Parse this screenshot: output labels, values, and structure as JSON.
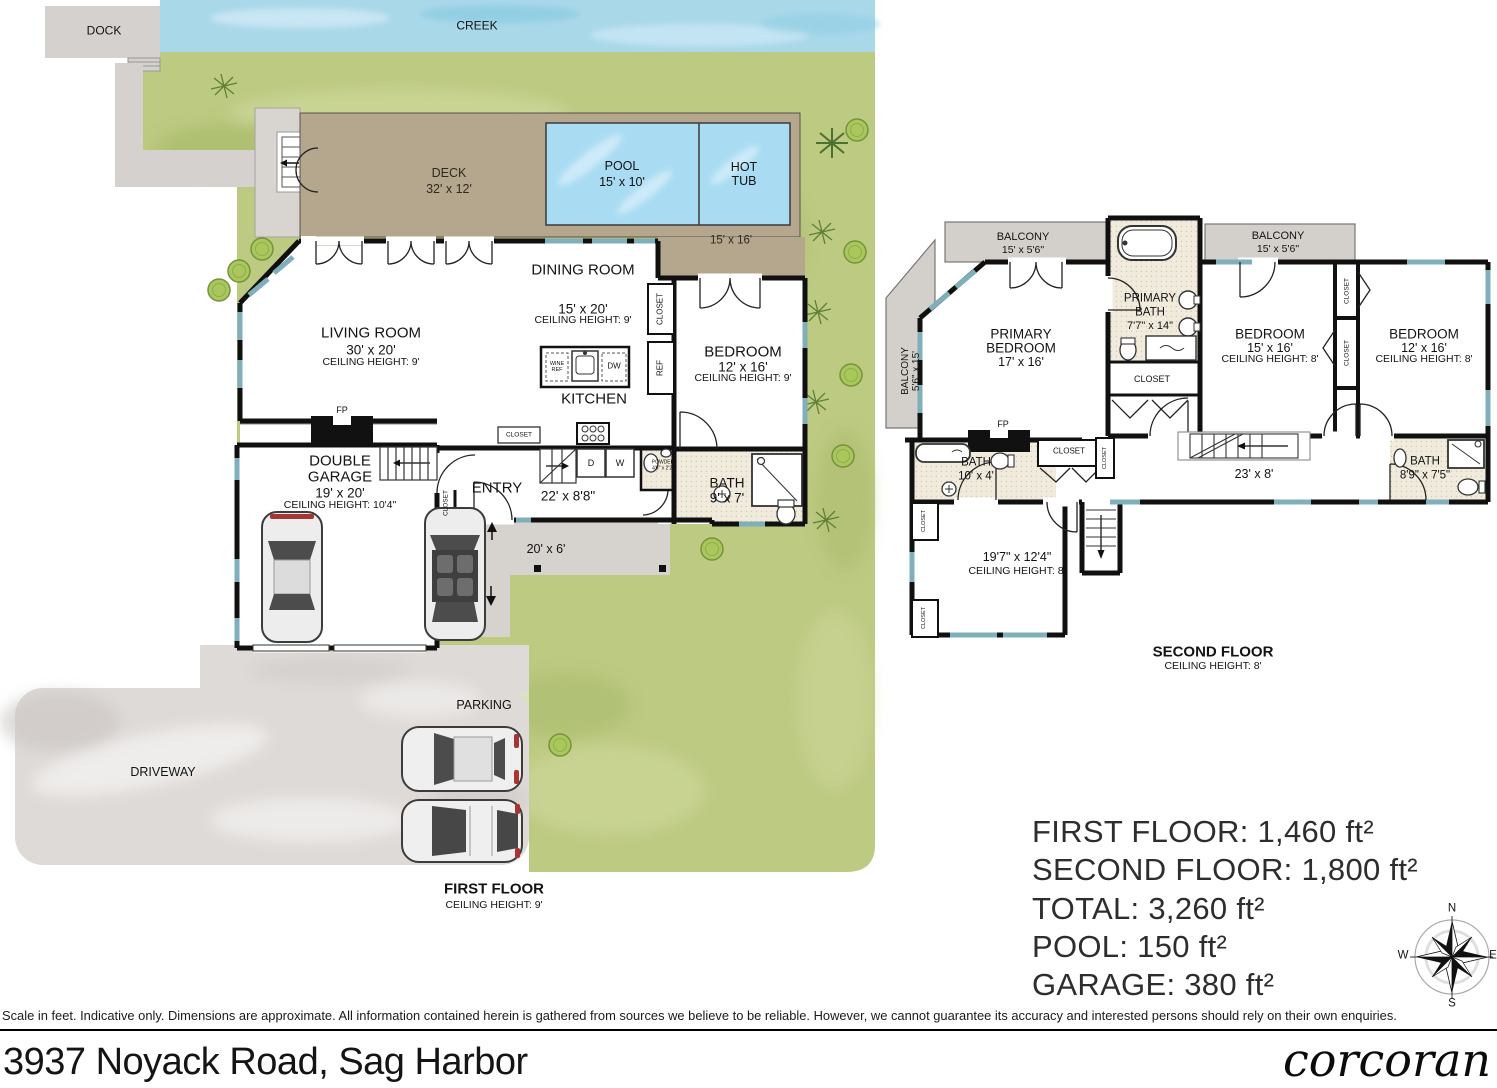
{
  "site": {
    "dock": "DOCK",
    "creek": "CREEK",
    "deck": {
      "name": "DECK",
      "dims": "32' x 12'"
    },
    "pool": {
      "name": "POOL",
      "dims": "15' x 10'"
    },
    "hot_tub": "HOT\nTUB",
    "pool_patio_dims": "15' x 16'",
    "walkway_dims": "20' x 6'",
    "driveway": "DRIVEWAY",
    "parking": "PARKING"
  },
  "labels": {
    "closet": "CLOSET",
    "fp": "FP",
    "ref": "REF",
    "wine_ref": "WINE\nREF",
    "dw": "DW",
    "d": "D",
    "w": "W",
    "powder": "POWDER\n4'6\" x 2'2\""
  },
  "first_floor": {
    "title": "FIRST FLOOR",
    "ceiling": "CEILING HEIGHT: 9'",
    "living": {
      "name": "LIVING ROOM",
      "dims": "30' x 20'",
      "ceiling": "CEILING HEIGHT: 9'"
    },
    "dining": {
      "name": "DINING ROOM",
      "dims": "15' x 20'",
      "ceiling": "CEILING HEIGHT: 9'"
    },
    "kitchen": "KITCHEN",
    "bedroom": {
      "name": "BEDROOM",
      "dims": "12' x 16'",
      "ceiling": "CEILING HEIGHT: 9'"
    },
    "bath": {
      "name": "BATH",
      "dims": "9' x 7'"
    },
    "entry": {
      "name": "ENTRY",
      "dims": "22' x 8'8\""
    },
    "garage": {
      "line1": "DOUBLE",
      "line2": "GARAGE",
      "dims": "19' x 20'",
      "ceiling": "CEILING HEIGHT: 10'4\""
    }
  },
  "second_floor": {
    "title": "SECOND FLOOR",
    "ceiling": "CEILING HEIGHT: 8'",
    "balcony_top_left": {
      "name": "BALCONY",
      "dims": "15' x 5'6\""
    },
    "balcony_top_right": {
      "name": "BALCONY",
      "dims": "15' x 5'6\""
    },
    "balcony_left": {
      "name": "BALCONY",
      "dims": "5'6\" x 15'"
    },
    "primary_bedroom": {
      "line1": "PRIMARY",
      "line2": "BEDROOM",
      "dims": "17' x 16'"
    },
    "primary_bath": {
      "line1": "PRIMARY",
      "line2": "BATH",
      "dims": "7'7\" x 14\""
    },
    "bath_left": {
      "name": "BATH",
      "dims": "10' x 4'"
    },
    "bedroom_middle": {
      "name": "BEDROOM",
      "dims": "15' x 16'",
      "ceiling": "CEILING HEIGHT: 8'"
    },
    "bedroom_right": {
      "name": "BEDROOM",
      "dims": "12' x 16'",
      "ceiling": "CEILING HEIGHT: 8'"
    },
    "bonus_room": {
      "dims": "19'7\" x 12'4\"",
      "ceiling": "CEILING HEIGHT: 8'"
    },
    "hall_dims": "23' x 8'",
    "bath_right": {
      "name": "BATH",
      "dims": "8'9\" x 7'5\""
    }
  },
  "stats": {
    "first_floor": "FIRST FLOOR: 1,460 ft²",
    "second_floor": "SECOND FLOOR: 1,800 ft²",
    "total": "TOTAL: 3,260 ft²",
    "pool": "POOL: 150 ft²",
    "garage": "GARAGE: 380 ft²"
  },
  "compass": {
    "n": "N",
    "s": "S",
    "e": "E",
    "w": "W"
  },
  "footer": {
    "disclaimer": "Scale in feet. Indicative only. Dimensions are approximate. All information contained herein is gathered from sources we believe to be reliable. However, we cannot guarantee its accuracy and interested persons should rely on their own enquiries.",
    "address": "3937 Noyack Road, Sag Harbor",
    "brand": "corcoran"
  }
}
